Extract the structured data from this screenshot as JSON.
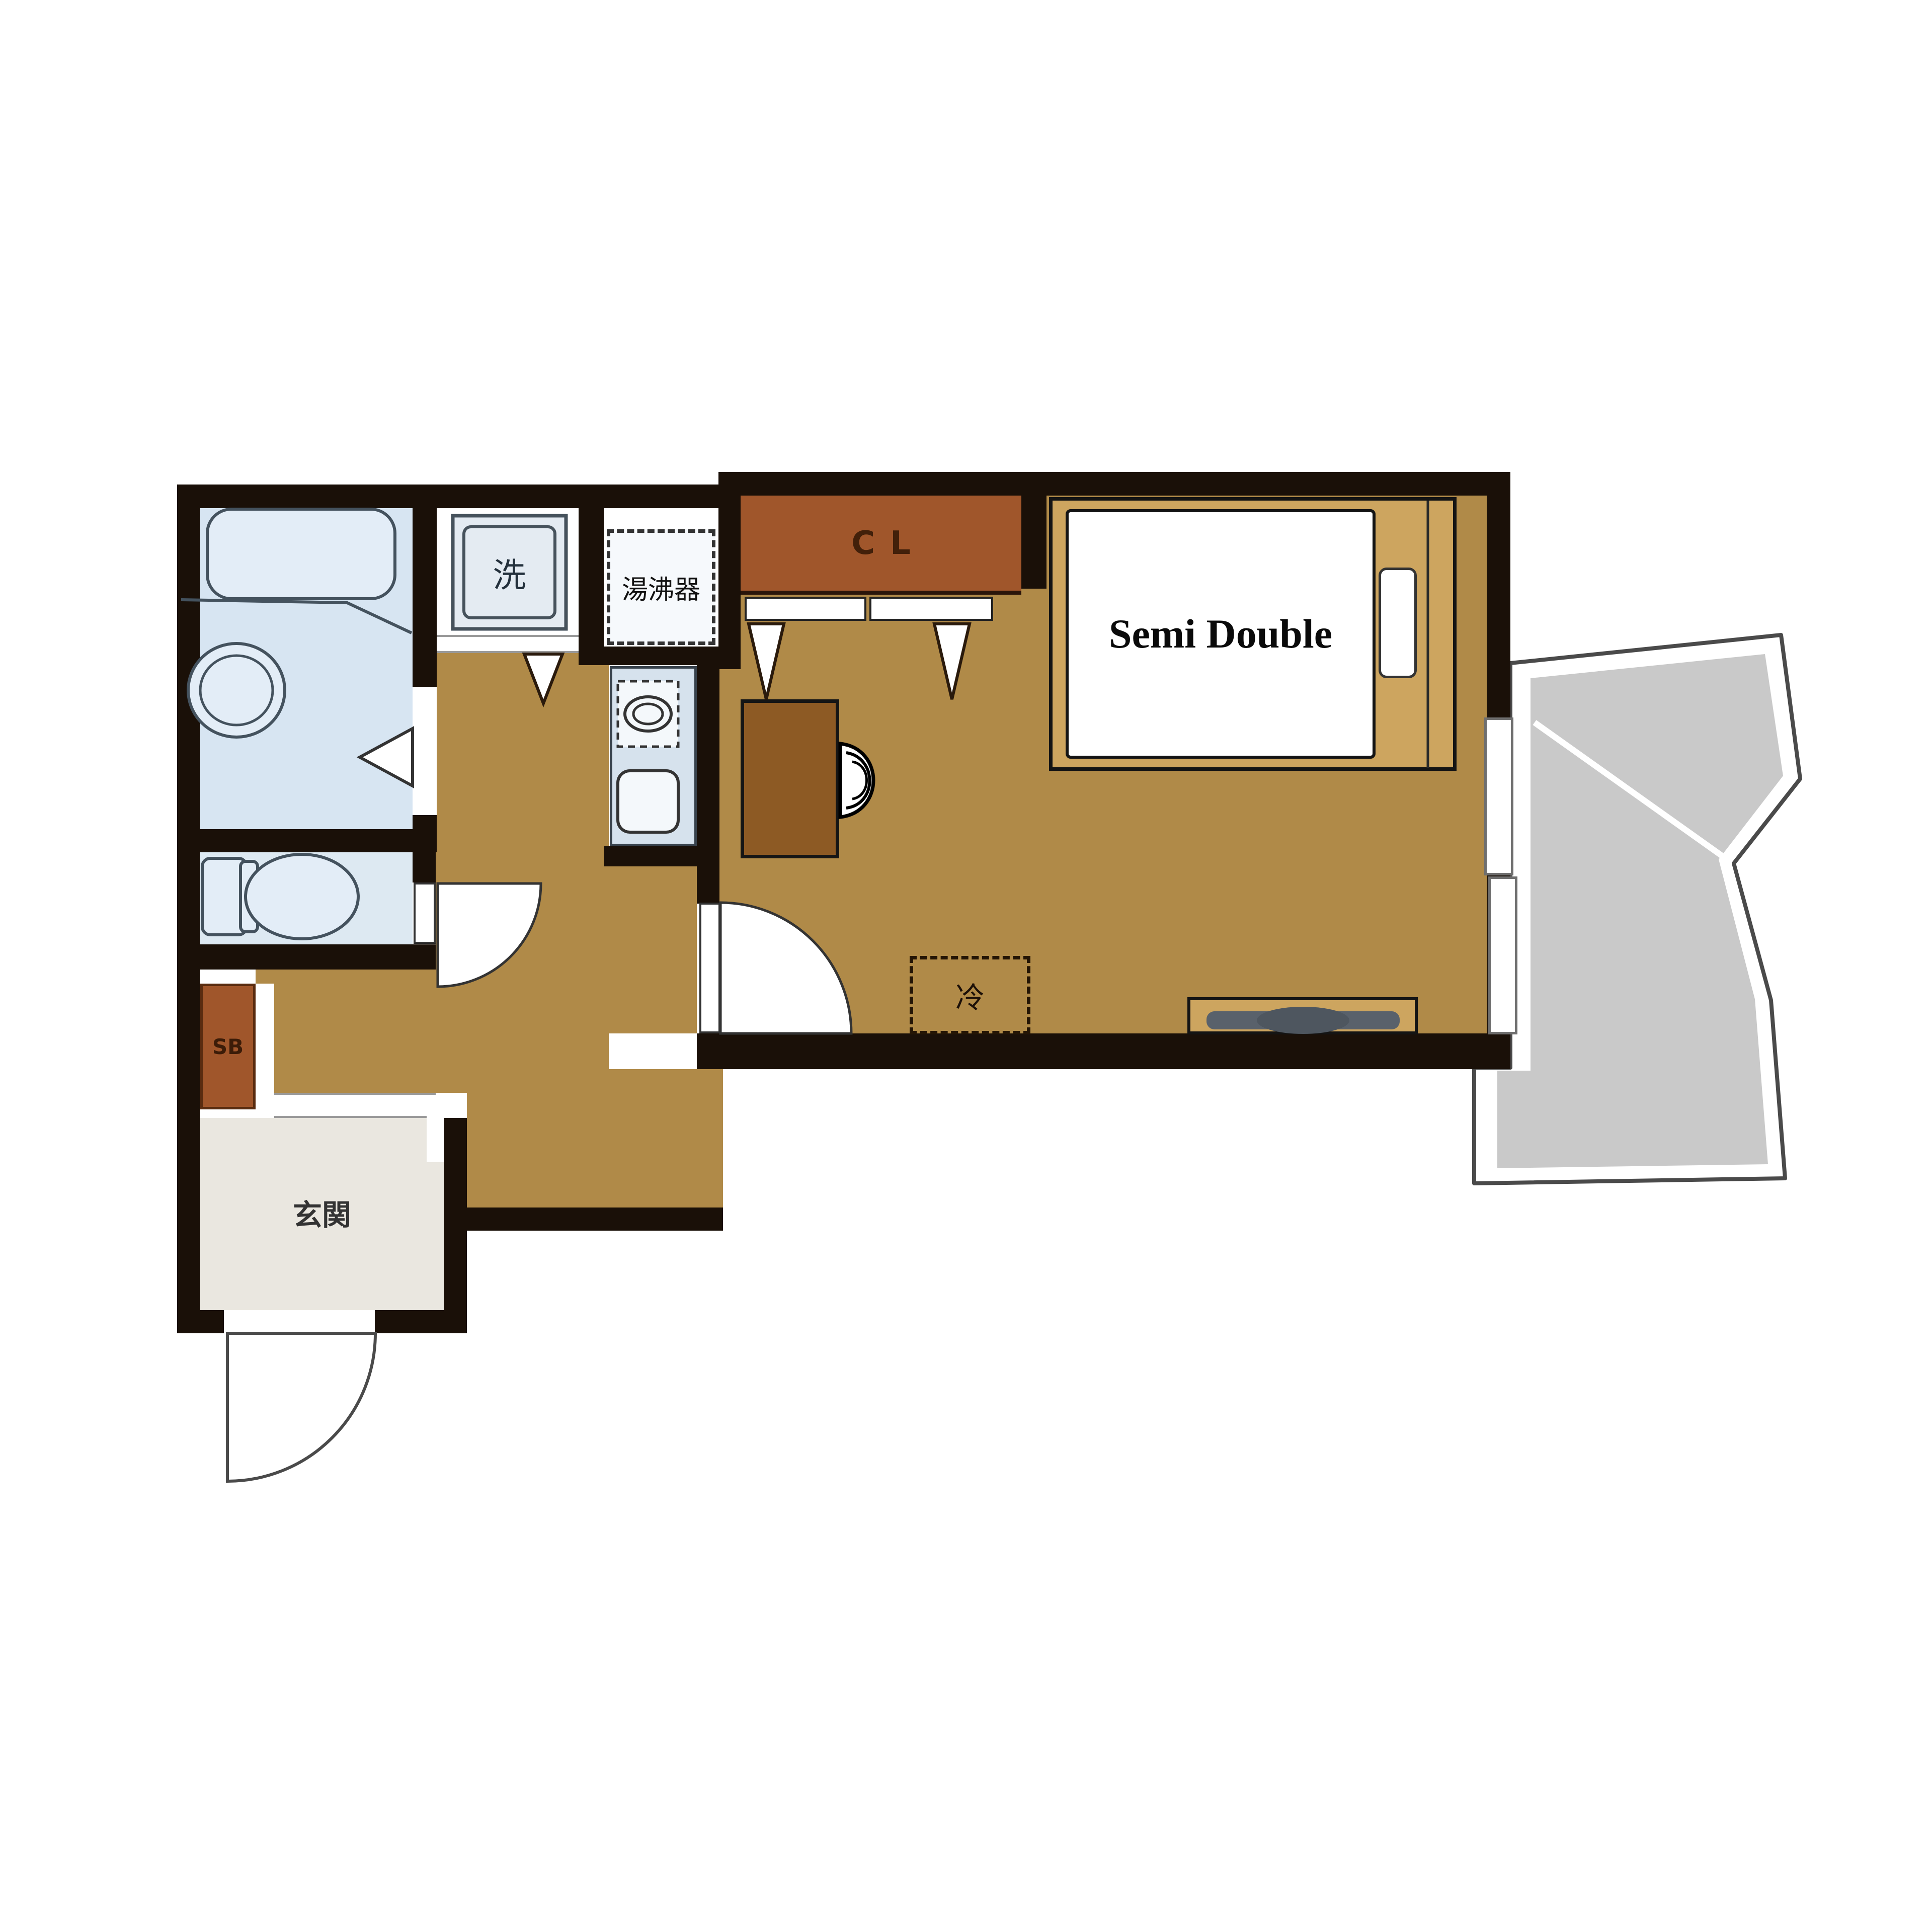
{
  "title": "apartment-floor-plan",
  "labels": {
    "closet": "CL",
    "bed": "Semi Double",
    "refrigerator": "冷",
    "washing_machine": "洗",
    "water_heater": "湯沸器",
    "shoe_box": "SB",
    "entrance": "玄関"
  },
  "colors": {
    "wall": "#1a1008",
    "floor": "#b08a48",
    "closet": "#a0562b",
    "desk": "#8d5a24",
    "bed_frame": "#cda55f",
    "balcony": "#c9c9c9",
    "bathroom": "#d7e5f2",
    "toilet": "#dde9f2",
    "kitchen": "#d6e2ed",
    "entrance_floor": "#eae7e0",
    "fixture_line": "#44525e"
  }
}
